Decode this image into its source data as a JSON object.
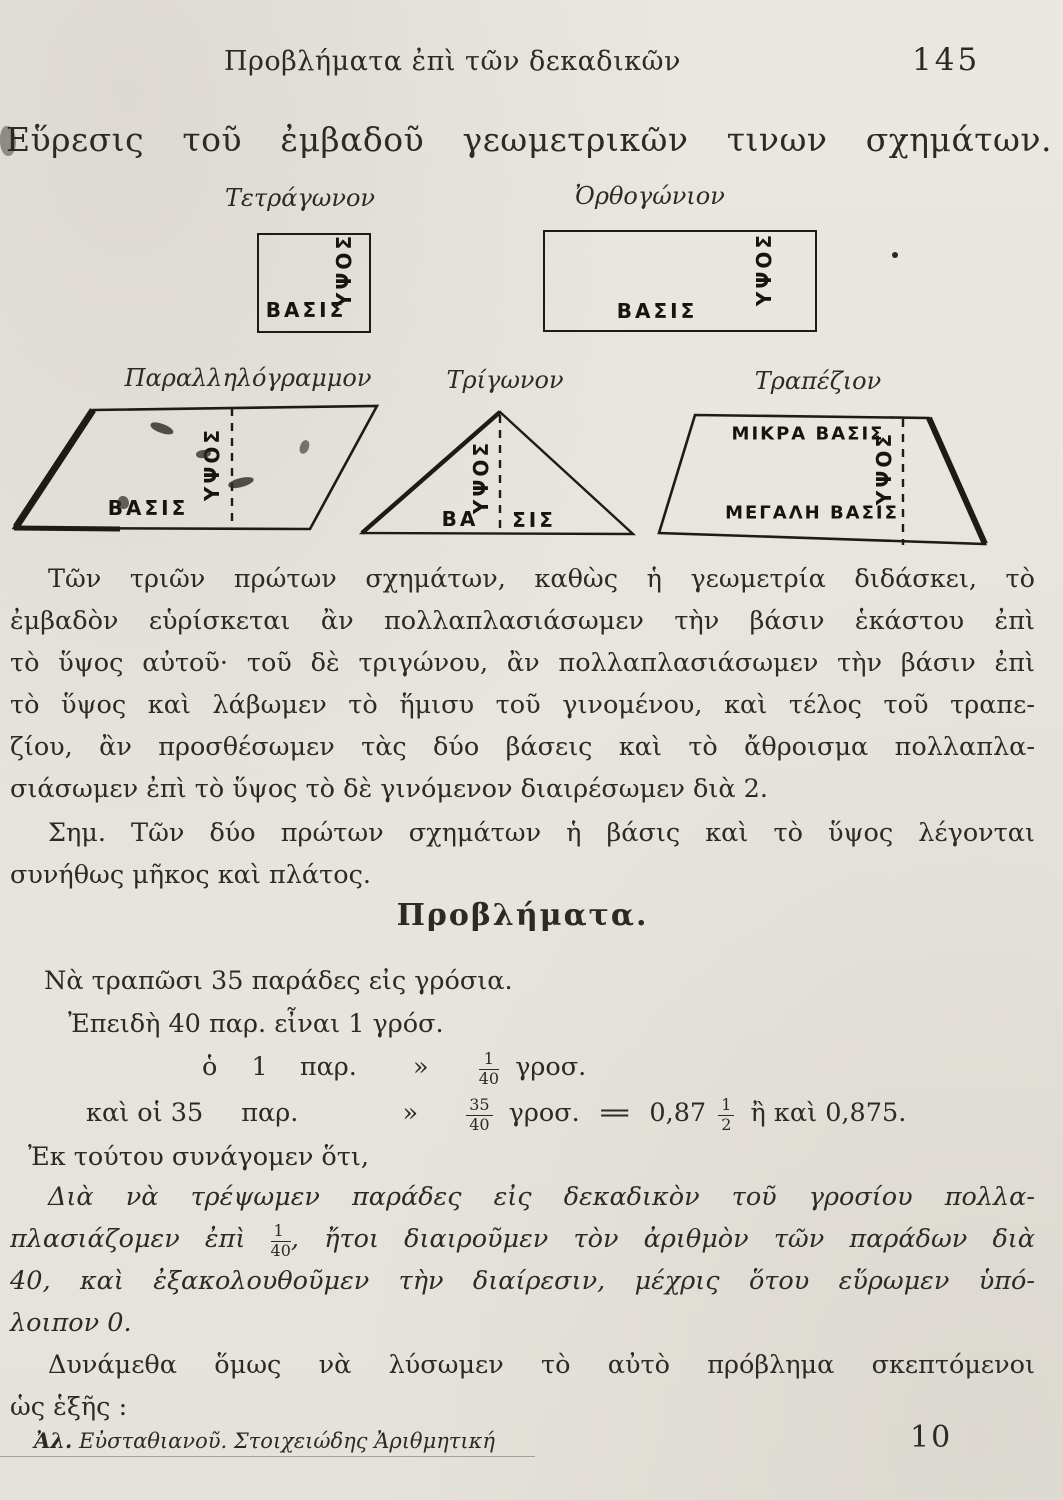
{
  "colors": {
    "paper": "#e7e4de",
    "ink": "#2c2a25"
  },
  "header": {
    "running_title": "Προβλήματα ἐπὶ τῶν δεκαδικῶν",
    "page_number": "145"
  },
  "title": "Εὕρεσις τοῦ ἐμβαδοῦ γεωμετρικῶν τινων σχημάτων.",
  "figures": {
    "square": {
      "caption": "Τετράγωνον",
      "base_label": "ΒΑΣΙΣ",
      "height_label": "ΥΨΟΣ"
    },
    "rectangle": {
      "caption": "Ὀρθογώνιον",
      "base_label": "ΒΑΣΙΣ",
      "height_label": "ΥΨΟΣ"
    },
    "parallelogram": {
      "caption": "Παραλληλόγραμμον",
      "base_label": "ΒΑΣΙΣ",
      "height_label": "ΥΨΟΣ"
    },
    "triangle": {
      "caption": "Τρίγωνον",
      "base_label_left": "ΒΑ",
      "base_label_right": "ΣΙΣ",
      "height_label": "ΥΨΟΣ"
    },
    "trapezoid": {
      "caption": "Τραπέζιον",
      "small_base_label": "ΜΙΚΡΑ ΒΑΣΙΣ",
      "large_base_label": "ΜΕΓΑΛΗ ΒΑΣΙΣ",
      "height_label": "ΥΨΟΣ"
    }
  },
  "paragraph1": {
    "lines": [
      "Τῶν τριῶν πρώτων σχημάτων, καθὼς ἡ γεωμετρία διδάσκει, τὸ",
      "ἐμβαδὸν εὑρίσκεται ἂν πολλαπλασιάσωμεν τὴν βάσιν ἑκάστου ἐπὶ",
      "τὸ ὕψος αὐτοῦ· τοῦ δὲ τριγώνου, ἂν πολλαπλασιάσωμεν τὴν βάσιν ἐπὶ",
      "τὸ ὕψος καὶ λάβωμεν τὸ ἥμισυ τοῦ γινομένου, καὶ τέλος τοῦ τραπε-",
      "ζίου, ἂν προσθέσωμεν τὰς δύο βάσεις καὶ τὸ ἄθροισμα πολλαπλα-",
      "σιάσωμεν ἐπὶ τὸ ὕψος τὸ δὲ γινόμενον διαιρέσωμεν διὰ 2."
    ]
  },
  "note": {
    "lines": [
      "Σημ. Τῶν δύο πρώτων σχημάτων ἡ βάσις καὶ τὸ ὕψος λέγονται",
      "συνήθως μῆκος καὶ πλάτος."
    ]
  },
  "problems": {
    "heading": "Προβλήματα.",
    "line1": "Νὰ τραπῶσι 35 παράδες εἰς γρόσια.",
    "line2": "Ἐπειδὴ 40 παρ.  εἶναι  1  γρόσ.",
    "line3": {
      "s1": "ὁ",
      "s2": "1",
      "s3": "παρ.",
      "ditto": "»",
      "frac_num": "1",
      "frac_den": "40",
      "s4": "γροσ."
    },
    "line4": {
      "s1": "καὶ οἱ 35",
      "s2": "παρ.",
      "ditto": "»",
      "frac_num": "35",
      "frac_den": "40",
      "s3": "γροσ.",
      "eq": "=",
      "s4": "0,87",
      "half_num": "1",
      "half_den": "2",
      "s5": "ἢ καὶ 0,875."
    },
    "line5": "Ἐκ τούτου συνάγομεν ὅτι,"
  },
  "conclusion": {
    "line1": "Διὰ νὰ τρέψωμεν παράδες εἰς δεκαδικὸν τοῦ γροσίου πολλα-",
    "line2a": "πλασιάζομεν ἐπὶ",
    "frac_num": "1",
    "frac_den": "40",
    "line2b": ", ἤτοι διαιροῦμεν τὸν ἀριθμὸν τῶν παράδων διὰ",
    "line3": "40, καὶ ἐξακολουθοῦμεν τὴν διαίρεσιν, μέχρις ὅτου εὕρωμεν ὑπό-",
    "line4": "λοιπον 0."
  },
  "closing": {
    "lines": [
      "Δυνάμεθα ὅμως νὰ λύσωμεν τὸ αὐτὸ πρόβλημα σκεπτόμενοι",
      "ὡς ἑξῆς :"
    ]
  },
  "footer": {
    "author_abbrev": "Ἀλ.",
    "reference_rest": " Εὐσταθιανοῦ. Στοιχειώδης Ἀριθμητική",
    "signature_number": "10"
  }
}
